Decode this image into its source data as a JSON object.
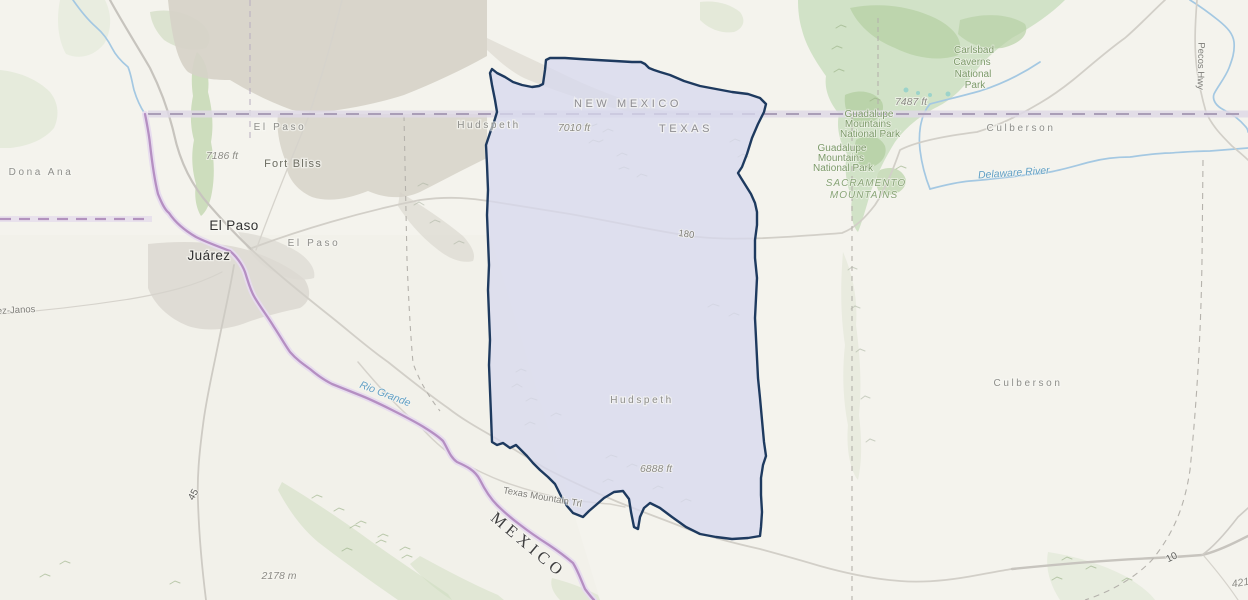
{
  "labels": {
    "states": {
      "new_mexico": "NEW MEXICO",
      "texas": "TEXAS"
    },
    "country": {
      "mexico": "MEXICO"
    },
    "counties": {
      "dona_ana": "Dona Ana",
      "el_paso": "El Paso",
      "hudspeth": "Hudspeth",
      "culberson": "Culberson"
    },
    "cities": {
      "el_paso": "El Paso",
      "juarez": "Juárez"
    },
    "military": {
      "fort_bliss": "Fort Bliss"
    },
    "parks": {
      "carlsbad_l1": "Carlsbad",
      "carlsbad_l2": "Caverns",
      "carlsbad_l3": "National",
      "carlsbad_l4": "Park",
      "guadalupe_a_l1": "Guadalupe",
      "guadalupe_a_l2": "Mountains",
      "guadalupe_a_l3": "National Park",
      "guadalupe_b_l1": "Guadalupe",
      "guadalupe_b_l2": "Mountains",
      "guadalupe_b_l3": "National Park",
      "sacramento_l1": "SACRAMENTO",
      "sacramento_l2": "MOUNTAINS"
    },
    "water": {
      "rio_grande": "Rio Grande",
      "delaware_river": "Delaware River"
    },
    "roads": {
      "interstate_10": "10",
      "us_180": "180",
      "mex_45": "45",
      "pecos_hwy": "Pecos Hwy",
      "texas_mountain_trl": "Texas Mountain Trl",
      "janos": "ez-Janos"
    },
    "elevations": {
      "peak_7010": "7010 ft",
      "peak_7186": "7186 ft",
      "peak_7487": "7487 ft",
      "peak_6888": "6888 ft",
      "peak_2178": "2178 m",
      "peak_421": "421"
    }
  },
  "highlight": {
    "county": "Hudspeth",
    "fill": "#d7d8ed",
    "fill_opacity": "0.75",
    "stroke": "#1e3a5f"
  }
}
